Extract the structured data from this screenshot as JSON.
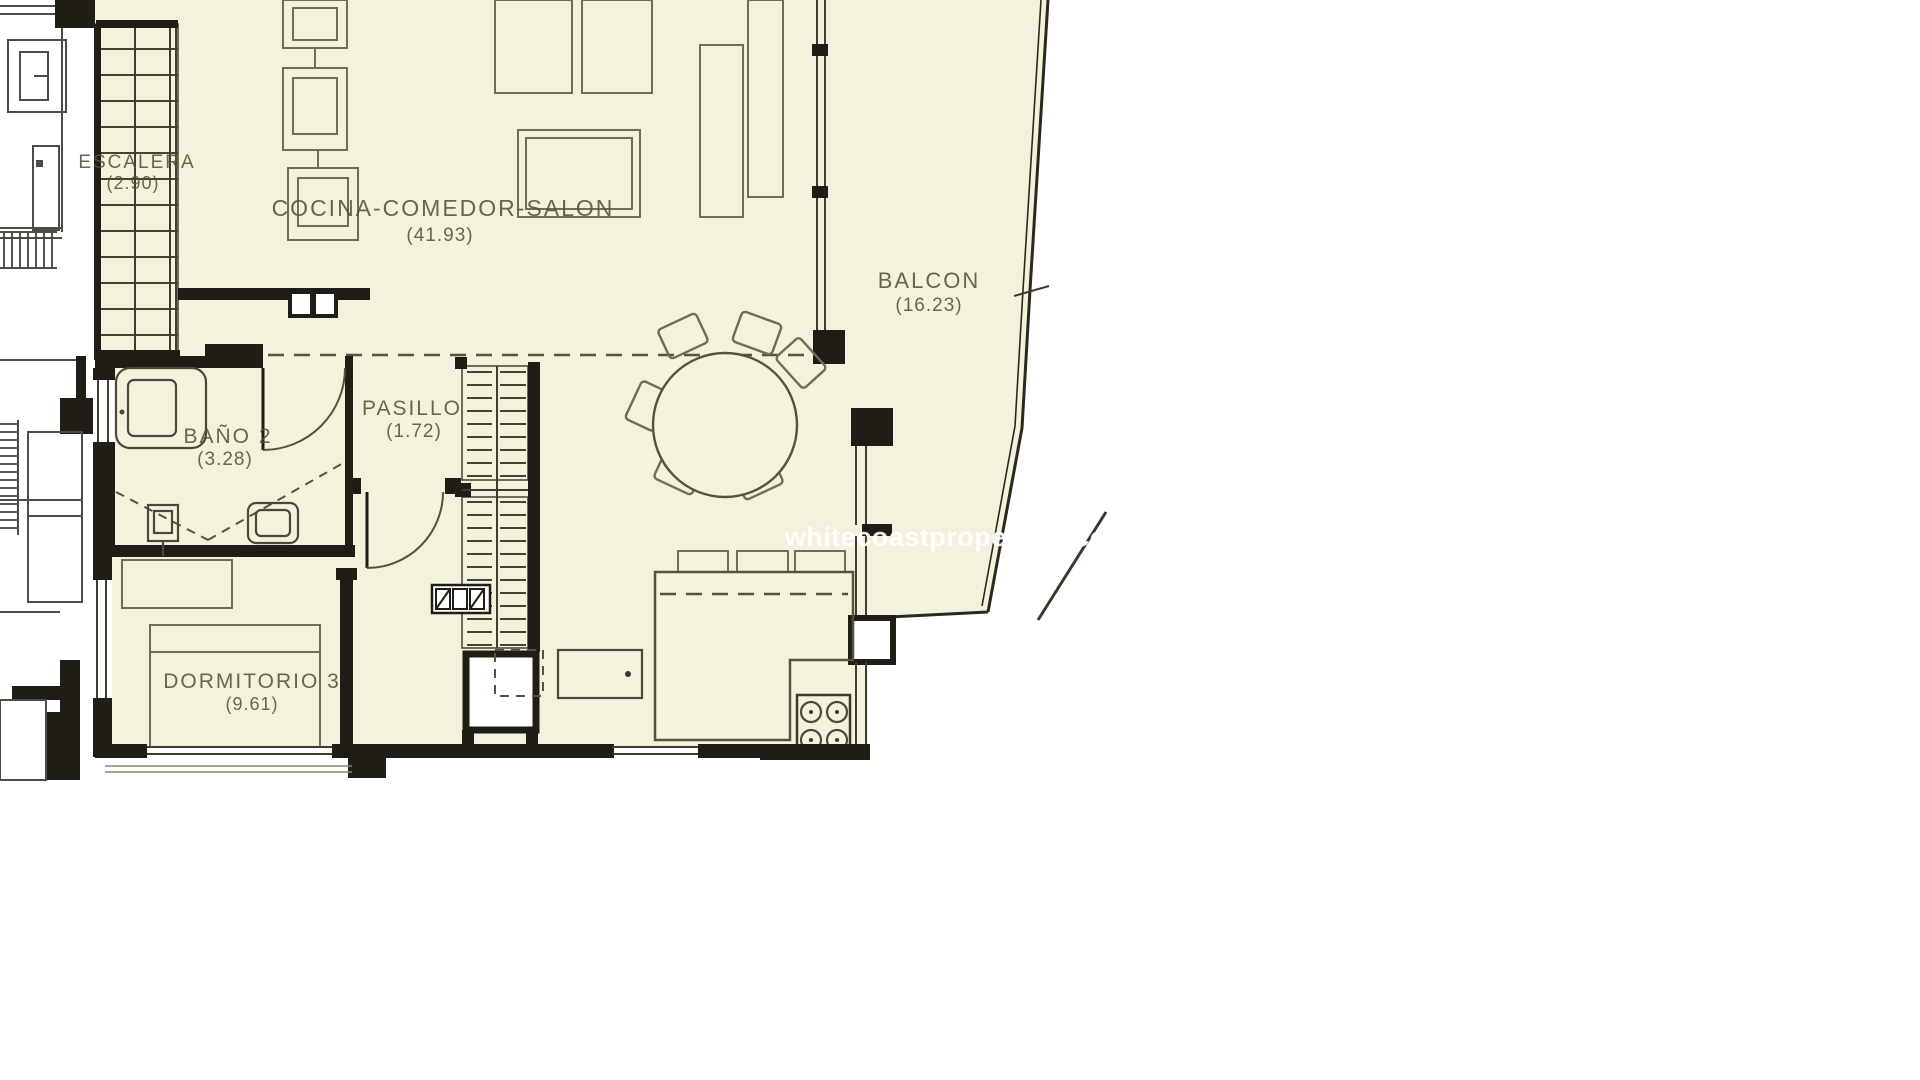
{
  "watermark": "whitecoastproperties.com",
  "rooms": [
    {
      "name": "ESCALERA",
      "area": "(2.90)"
    },
    {
      "name": "COCINA-COMEDOR-SALON",
      "area": "(41.93)"
    },
    {
      "name": "BALCON",
      "area": "(16.23)"
    },
    {
      "name": "BAÑO 2",
      "area": "(3.28)"
    },
    {
      "name": "PASILLO",
      "area": "(1.72)"
    },
    {
      "name": "DORMITORIO 3",
      "area": "(9.61)"
    }
  ],
  "colors": {
    "interior": "#f4f1dc",
    "walls": "#1f1d15",
    "furniture": "#6f6d5a",
    "labels": "#55523c",
    "watermark": "#ffffff"
  }
}
